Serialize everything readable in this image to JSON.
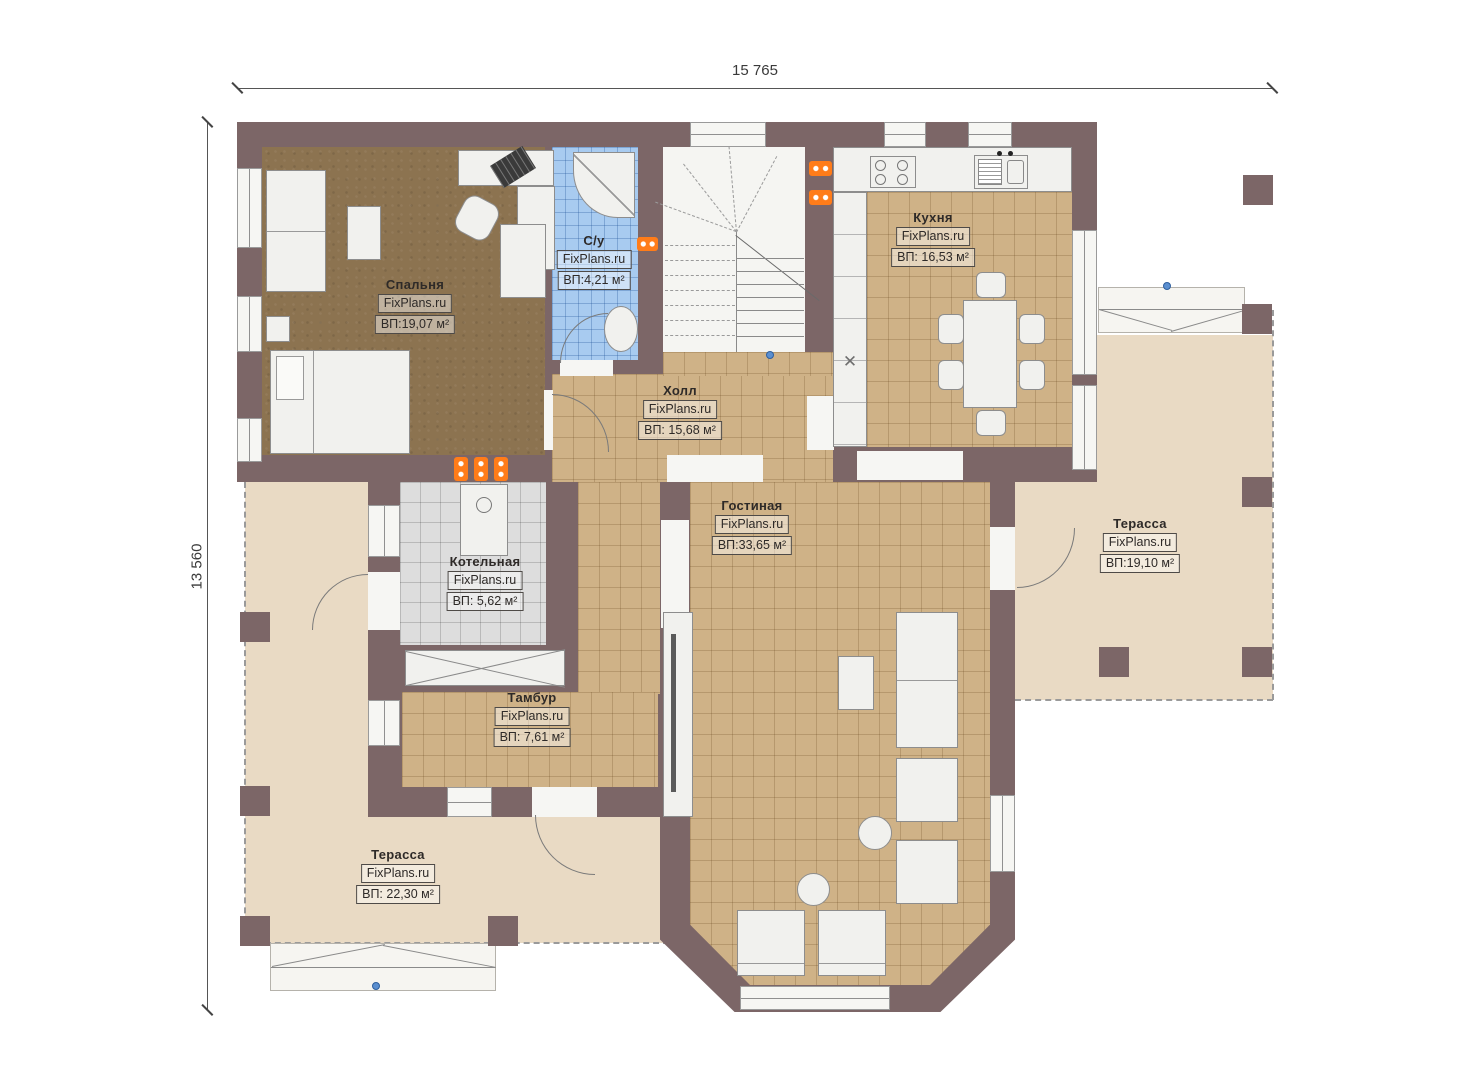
{
  "dimensions": {
    "top": "15 765",
    "left": "13 560"
  },
  "watermark": "FixPlans.ru",
  "rooms": [
    {
      "name": "Спальня",
      "watermark": "FixPlans.ru",
      "area": "ВП:19,07 м²"
    },
    {
      "name": "С/у",
      "watermark": "FixPlans.ru",
      "area": "ВП:4,21 м²"
    },
    {
      "name": "Кухня",
      "watermark": "FixPlans.ru",
      "area": "ВП: 16,53 м²"
    },
    {
      "name": "Холл",
      "watermark": "FixPlans.ru",
      "area": "ВП: 15,68 м²"
    },
    {
      "name": "Гостиная",
      "watermark": "FixPlans.ru",
      "area": "ВП:33,65 м²"
    },
    {
      "name": "Котельная",
      "watermark": "FixPlans.ru",
      "area": "ВП: 5,62 м²"
    },
    {
      "name": "Тамбур",
      "watermark": "FixPlans.ru",
      "area": "ВП: 7,61 м²"
    },
    {
      "name": "Терасса",
      "watermark": "FixPlans.ru",
      "area": "ВП:19,10 м²"
    },
    {
      "name": "Терасса",
      "watermark": "FixPlans.ru",
      "area": "ВП: 22,30 м²"
    }
  ],
  "colors": {
    "wall": "#7c6667",
    "wood_floor": "#8c7350",
    "tile_tan": "#cfb287",
    "tile_gray": "#dddddd",
    "tile_blue": "#a8cbf0",
    "terrace": "#e9dac4",
    "radiator": "#ff7c19",
    "marker_blue": "#5b8fd0"
  }
}
